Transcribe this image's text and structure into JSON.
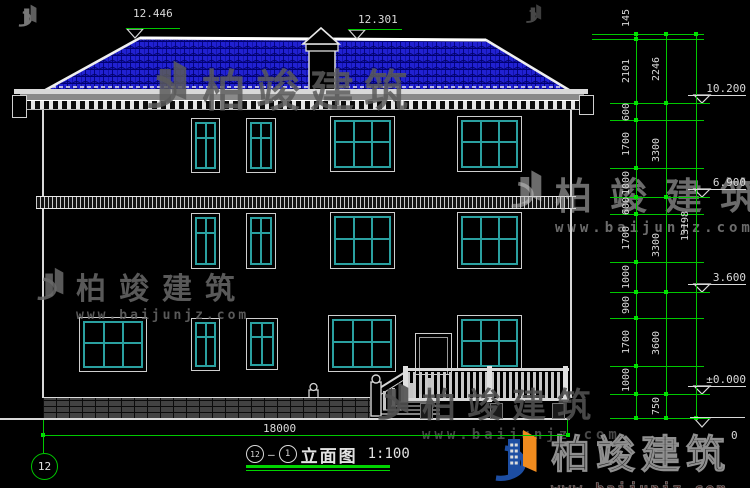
{
  "drawing_title": {
    "ref_left": "12",
    "separator": "—",
    "ref_right": "1",
    "name": "立面图",
    "scale": "1:100"
  },
  "axis_bubble_label": "12",
  "top_elevation_marks": [
    "12.446",
    "12.301"
  ],
  "right_elevation_marks": [
    "10.200",
    "6.900",
    "3.600",
    "±0.000",
    "0"
  ],
  "horizontal_dimension": "18000",
  "vertical_dimensions": {
    "inner_chain": [
      "145",
      "2101",
      "600",
      "1700",
      "1000",
      "600",
      "1700",
      "1000",
      "900",
      "1700",
      "1000",
      ""
    ],
    "middle_chain": [
      "2246",
      "3300",
      "3300",
      "3600",
      "750"
    ],
    "total": "13198"
  },
  "watermark": {
    "brand": "柏竣建筑",
    "url": "www.baijunjz.com"
  },
  "colors": {
    "bg": "#000000",
    "green": "#00c800",
    "white": "#d9d9d9",
    "teal": "#2aa0a0",
    "roof_blue": "#2121d2",
    "roof_grid": "#000070",
    "logo_blue": "#1d4ea3",
    "logo_orange": "#f08b1e"
  }
}
